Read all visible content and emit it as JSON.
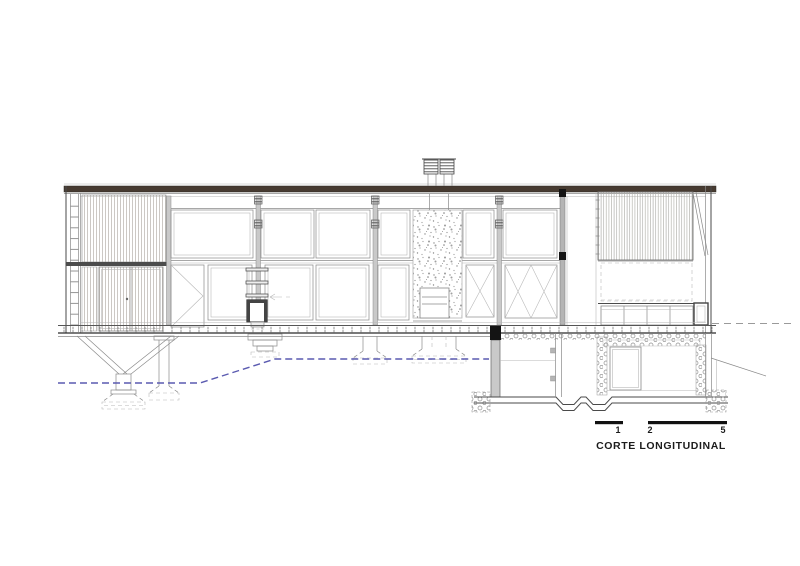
{
  "drawing": {
    "title": "CORTE LONGITUDINAL",
    "scale_bar": {
      "labels": [
        "1",
        "2",
        "5"
      ]
    },
    "colors": {
      "paper": "#ffffff",
      "ink": "#3f3f3f",
      "light_line": "#9a9a9a",
      "roof_fill": "#473b31",
      "ground_line": "#5a5ab0",
      "wall_fill": "#c9c9c9"
    }
  }
}
